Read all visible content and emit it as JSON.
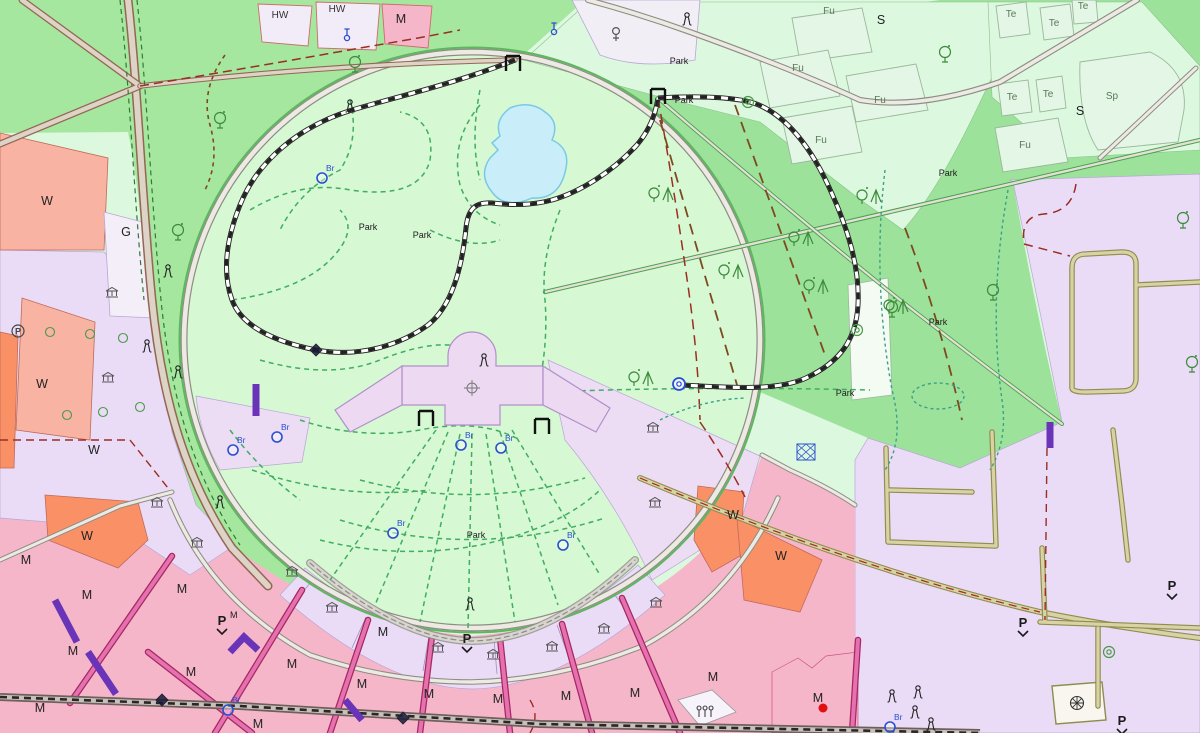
{
  "map": {
    "kind": "cadastral-zoning-map",
    "fountain_label": "Br",
    "parking_letter": "P"
  },
  "colors": {
    "mint_bg": "#dcf8de",
    "green_mid": "#a6e7a0",
    "green_right": "#9de29b",
    "park_light": "#d6f8d2",
    "parcel_mint": "#e4f6e5",
    "lavender": "#eadcf6",
    "lavender_light": "#efe6f8",
    "palace": "#eed9f3",
    "pink": "#f5b6ca",
    "salmon": "#f9b3a2",
    "orange": "#fa9166",
    "magenta_road": "#e671b0",
    "magenta_edge": "#a5285f",
    "road_gray_fill": "#eceae2",
    "road_gray_edge": "#8d8d85",
    "road_tan_fill": "#ddd3c6",
    "road_tan_edge": "#936753",
    "olive_fill": "#d9d2a4",
    "olive_edge": "#8f8c4f",
    "lake_fill": "#c9eefa",
    "lake_edge": "#79c9e8",
    "rail_band": "#6e5f5a",
    "path_green": "#3fae62",
    "path_teal": "#3aa08a",
    "boundary_red": "#9b2d23",
    "boundary_brown": "#7d4a1e",
    "purple_bar": "#6a34b8",
    "blue_sym": "#2a4fd0",
    "red_accent": "#e01010"
  },
  "labels": [
    {
      "t": "HW",
      "x": 280,
      "y": 18,
      "c": "lbl-zone-sm"
    },
    {
      "t": "HW",
      "x": 337,
      "y": 12,
      "c": "lbl-zone-sm"
    },
    {
      "t": "M",
      "x": 401,
      "y": 23,
      "c": "lbl-zone"
    },
    {
      "t": "S",
      "x": 881,
      "y": 24,
      "c": "lbl-zone"
    },
    {
      "t": "S",
      "x": 1080,
      "y": 115,
      "c": "lbl-zone"
    },
    {
      "t": "Sp",
      "x": 1112,
      "y": 99,
      "c": "lbl-field"
    },
    {
      "t": "Fu",
      "x": 829,
      "y": 14,
      "c": "lbl-field"
    },
    {
      "t": "Fu",
      "x": 798,
      "y": 71,
      "c": "lbl-field"
    },
    {
      "t": "Fu",
      "x": 880,
      "y": 103,
      "c": "lbl-field"
    },
    {
      "t": "Fu",
      "x": 821,
      "y": 143,
      "c": "lbl-field"
    },
    {
      "t": "Fu",
      "x": 1025,
      "y": 148,
      "c": "lbl-field"
    },
    {
      "t": "Te",
      "x": 1011,
      "y": 17,
      "c": "lbl-field"
    },
    {
      "t": "Te",
      "x": 1054,
      "y": 26,
      "c": "lbl-field"
    },
    {
      "t": "Te",
      "x": 1083,
      "y": 9,
      "c": "lbl-field"
    },
    {
      "t": "Te",
      "x": 1012,
      "y": 100,
      "c": "lbl-field"
    },
    {
      "t": "Te",
      "x": 1048,
      "y": 97,
      "c": "lbl-field"
    },
    {
      "t": "W",
      "x": 47,
      "y": 205,
      "c": "lbl-zone"
    },
    {
      "t": "G",
      "x": 126,
      "y": 236,
      "c": "lbl-zone"
    },
    {
      "t": "W",
      "x": 42,
      "y": 388,
      "c": "lbl-zone"
    },
    {
      "t": "W",
      "x": 94,
      "y": 454,
      "c": "lbl-zone"
    },
    {
      "t": "W",
      "x": 87,
      "y": 540,
      "c": "lbl-zone"
    },
    {
      "t": "W",
      "x": 733,
      "y": 519,
      "c": "lbl-zone"
    },
    {
      "t": "W",
      "x": 781,
      "y": 560,
      "c": "lbl-zone"
    },
    {
      "t": "Park",
      "x": 368,
      "y": 230,
      "c": "lbl-park"
    },
    {
      "t": "Park",
      "x": 422,
      "y": 238,
      "c": "lbl-park"
    },
    {
      "t": "Park",
      "x": 476,
      "y": 538,
      "c": "lbl-park"
    },
    {
      "t": "Park",
      "x": 679,
      "y": 64,
      "c": "lbl-park"
    },
    {
      "t": "Park",
      "x": 684,
      "y": 103,
      "c": "lbl-park"
    },
    {
      "t": "Park",
      "x": 948,
      "y": 176,
      "c": "lbl-park"
    },
    {
      "t": "Park",
      "x": 938,
      "y": 325,
      "c": "lbl-park"
    },
    {
      "t": "Park",
      "x": 845,
      "y": 396,
      "c": "lbl-park"
    },
    {
      "t": "M",
      "x": 26,
      "y": 564,
      "c": "lbl-zone"
    },
    {
      "t": "M",
      "x": 87,
      "y": 599,
      "c": "lbl-zone"
    },
    {
      "t": "M",
      "x": 182,
      "y": 593,
      "c": "lbl-zone"
    },
    {
      "t": "M",
      "x": 73,
      "y": 655,
      "c": "lbl-zone"
    },
    {
      "t": "M",
      "x": 40,
      "y": 712,
      "c": "lbl-zone"
    },
    {
      "t": "M",
      "x": 191,
      "y": 676,
      "c": "lbl-zone"
    },
    {
      "t": "M",
      "x": 292,
      "y": 668,
      "c": "lbl-zone"
    },
    {
      "t": "M",
      "x": 383,
      "y": 636,
      "c": "lbl-zone"
    },
    {
      "t": "M",
      "x": 362,
      "y": 688,
      "c": "lbl-zone"
    },
    {
      "t": "M",
      "x": 429,
      "y": 698,
      "c": "lbl-zone"
    },
    {
      "t": "M",
      "x": 498,
      "y": 703,
      "c": "lbl-zone"
    },
    {
      "t": "M",
      "x": 566,
      "y": 700,
      "c": "lbl-zone"
    },
    {
      "t": "M",
      "x": 635,
      "y": 697,
      "c": "lbl-zone"
    },
    {
      "t": "M",
      "x": 713,
      "y": 681,
      "c": "lbl-zone"
    },
    {
      "t": "M",
      "x": 258,
      "y": 728,
      "c": "lbl-zone"
    },
    {
      "t": "M",
      "x": 818,
      "y": 702,
      "c": "lbl-zone"
    }
  ],
  "symbols": {
    "fountains": [
      {
        "x": 322,
        "y": 178
      },
      {
        "x": 233,
        "y": 450
      },
      {
        "x": 277,
        "y": 437
      },
      {
        "x": 461,
        "y": 445
      },
      {
        "x": 501,
        "y": 448
      },
      {
        "x": 393,
        "y": 533
      },
      {
        "x": 563,
        "y": 545
      },
      {
        "x": 228,
        "y": 710
      },
      {
        "x": 890,
        "y": 727
      }
    ],
    "hydrants": [
      {
        "x": 347,
        "y": 34
      },
      {
        "x": 554,
        "y": 28
      }
    ],
    "female": [
      {
        "x": 616,
        "y": 34
      }
    ],
    "museums": [
      {
        "x": 108,
        "y": 378
      },
      {
        "x": 112,
        "y": 293
      },
      {
        "x": 157,
        "y": 503
      },
      {
        "x": 197,
        "y": 543
      },
      {
        "x": 292,
        "y": 572
      },
      {
        "x": 332,
        "y": 608
      },
      {
        "x": 438,
        "y": 648
      },
      {
        "x": 493,
        "y": 655
      },
      {
        "x": 552,
        "y": 647
      },
      {
        "x": 604,
        "y": 629
      },
      {
        "x": 656,
        "y": 603
      },
      {
        "x": 653,
        "y": 428
      },
      {
        "x": 655,
        "y": 503
      }
    ],
    "statues": [
      {
        "x": 350,
        "y": 107
      },
      {
        "x": 687,
        "y": 20
      },
      {
        "x": 168,
        "y": 272
      },
      {
        "x": 147,
        "y": 347
      },
      {
        "x": 178,
        "y": 373
      },
      {
        "x": 470,
        "y": 605
      },
      {
        "x": 892,
        "y": 697
      },
      {
        "x": 918,
        "y": 693
      },
      {
        "x": 915,
        "y": 713
      },
      {
        "x": 931,
        "y": 725
      },
      {
        "x": 220,
        "y": 503
      },
      {
        "x": 484,
        "y": 361
      }
    ],
    "trees": [
      {
        "x": 220,
        "y": 118
      },
      {
        "x": 355,
        "y": 62
      },
      {
        "x": 178,
        "y": 230
      },
      {
        "x": 945,
        "y": 52
      },
      {
        "x": 993,
        "y": 290
      },
      {
        "x": 892,
        "y": 307
      },
      {
        "x": 1183,
        "y": 218
      },
      {
        "x": 1192,
        "y": 362
      }
    ],
    "mixed_trees": [
      {
        "x": 660,
        "y": 193
      },
      {
        "x": 868,
        "y": 195
      },
      {
        "x": 800,
        "y": 237
      },
      {
        "x": 730,
        "y": 270
      },
      {
        "x": 815,
        "y": 285
      },
      {
        "x": 895,
        "y": 305
      },
      {
        "x": 640,
        "y": 377
      }
    ],
    "street_trees": [
      {
        "x": 50,
        "y": 332
      },
      {
        "x": 90,
        "y": 334
      },
      {
        "x": 123,
        "y": 338
      },
      {
        "x": 67,
        "y": 415
      },
      {
        "x": 103,
        "y": 412
      },
      {
        "x": 140,
        "y": 407
      }
    ],
    "gates": [
      {
        "x": 513,
        "y": 62
      },
      {
        "x": 658,
        "y": 95
      },
      {
        "x": 426,
        "y": 417
      },
      {
        "x": 542,
        "y": 425
      }
    ],
    "station": [
      {
        "x": 679,
        "y": 384
      }
    ],
    "diamonds": [
      {
        "x": 316,
        "y": 350
      },
      {
        "x": 162,
        "y": 700
      },
      {
        "x": 403,
        "y": 718
      }
    ],
    "spirals": [
      {
        "x": 857,
        "y": 330
      },
      {
        "x": 748,
        "y": 102
      },
      {
        "x": 1109,
        "y": 652
      }
    ],
    "sunbursts": [
      {
        "x": 1077,
        "y": 703
      }
    ],
    "crowds": [
      {
        "x": 705,
        "y": 712
      }
    ],
    "blue_grids": [
      {
        "x": 806,
        "y": 452
      }
    ],
    "parking_circles": [
      {
        "x": 18,
        "y": 331
      }
    ],
    "red_dots": [
      {
        "x": 823,
        "y": 708
      }
    ]
  },
  "parking": [
    {
      "x": 222,
      "y": 625,
      "sup": "M"
    },
    {
      "x": 467,
      "y": 643,
      "sup": ""
    },
    {
      "x": 1172,
      "y": 590,
      "sup": ""
    },
    {
      "x": 1023,
      "y": 627,
      "sup": ""
    },
    {
      "x": 1122,
      "y": 725,
      "sup": ""
    }
  ],
  "transit_bars": [
    [
      [
        256,
        384
      ],
      [
        256,
        416
      ]
    ],
    [
      [
        1050,
        422
      ],
      [
        1050,
        448
      ]
    ],
    [
      [
        55,
        600
      ],
      [
        77,
        642
      ]
    ],
    [
      [
        88,
        652
      ],
      [
        116,
        694
      ]
    ],
    [
      [
        230,
        652
      ],
      [
        244,
        637
      ],
      [
        258,
        650
      ]
    ],
    [
      [
        345,
        700
      ],
      [
        362,
        720
      ]
    ]
  ]
}
